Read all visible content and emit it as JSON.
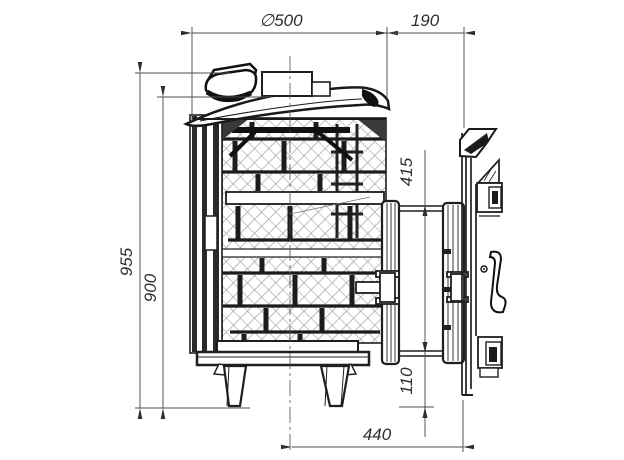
{
  "drawing_title": "stove-technical-drawing",
  "dimensions": {
    "diameter_top": "∅500",
    "tunnel_length": "190",
    "overall_height": "955",
    "body_height": "900",
    "portal_height": "415",
    "bottom_clearance": "110",
    "axis_to_door_face": "440"
  },
  "colors": {
    "outline": "#1f1f1f",
    "dimension_lines": "#4d4d4d",
    "mesh": "#8f8f8f",
    "background": "#ffffff"
  }
}
